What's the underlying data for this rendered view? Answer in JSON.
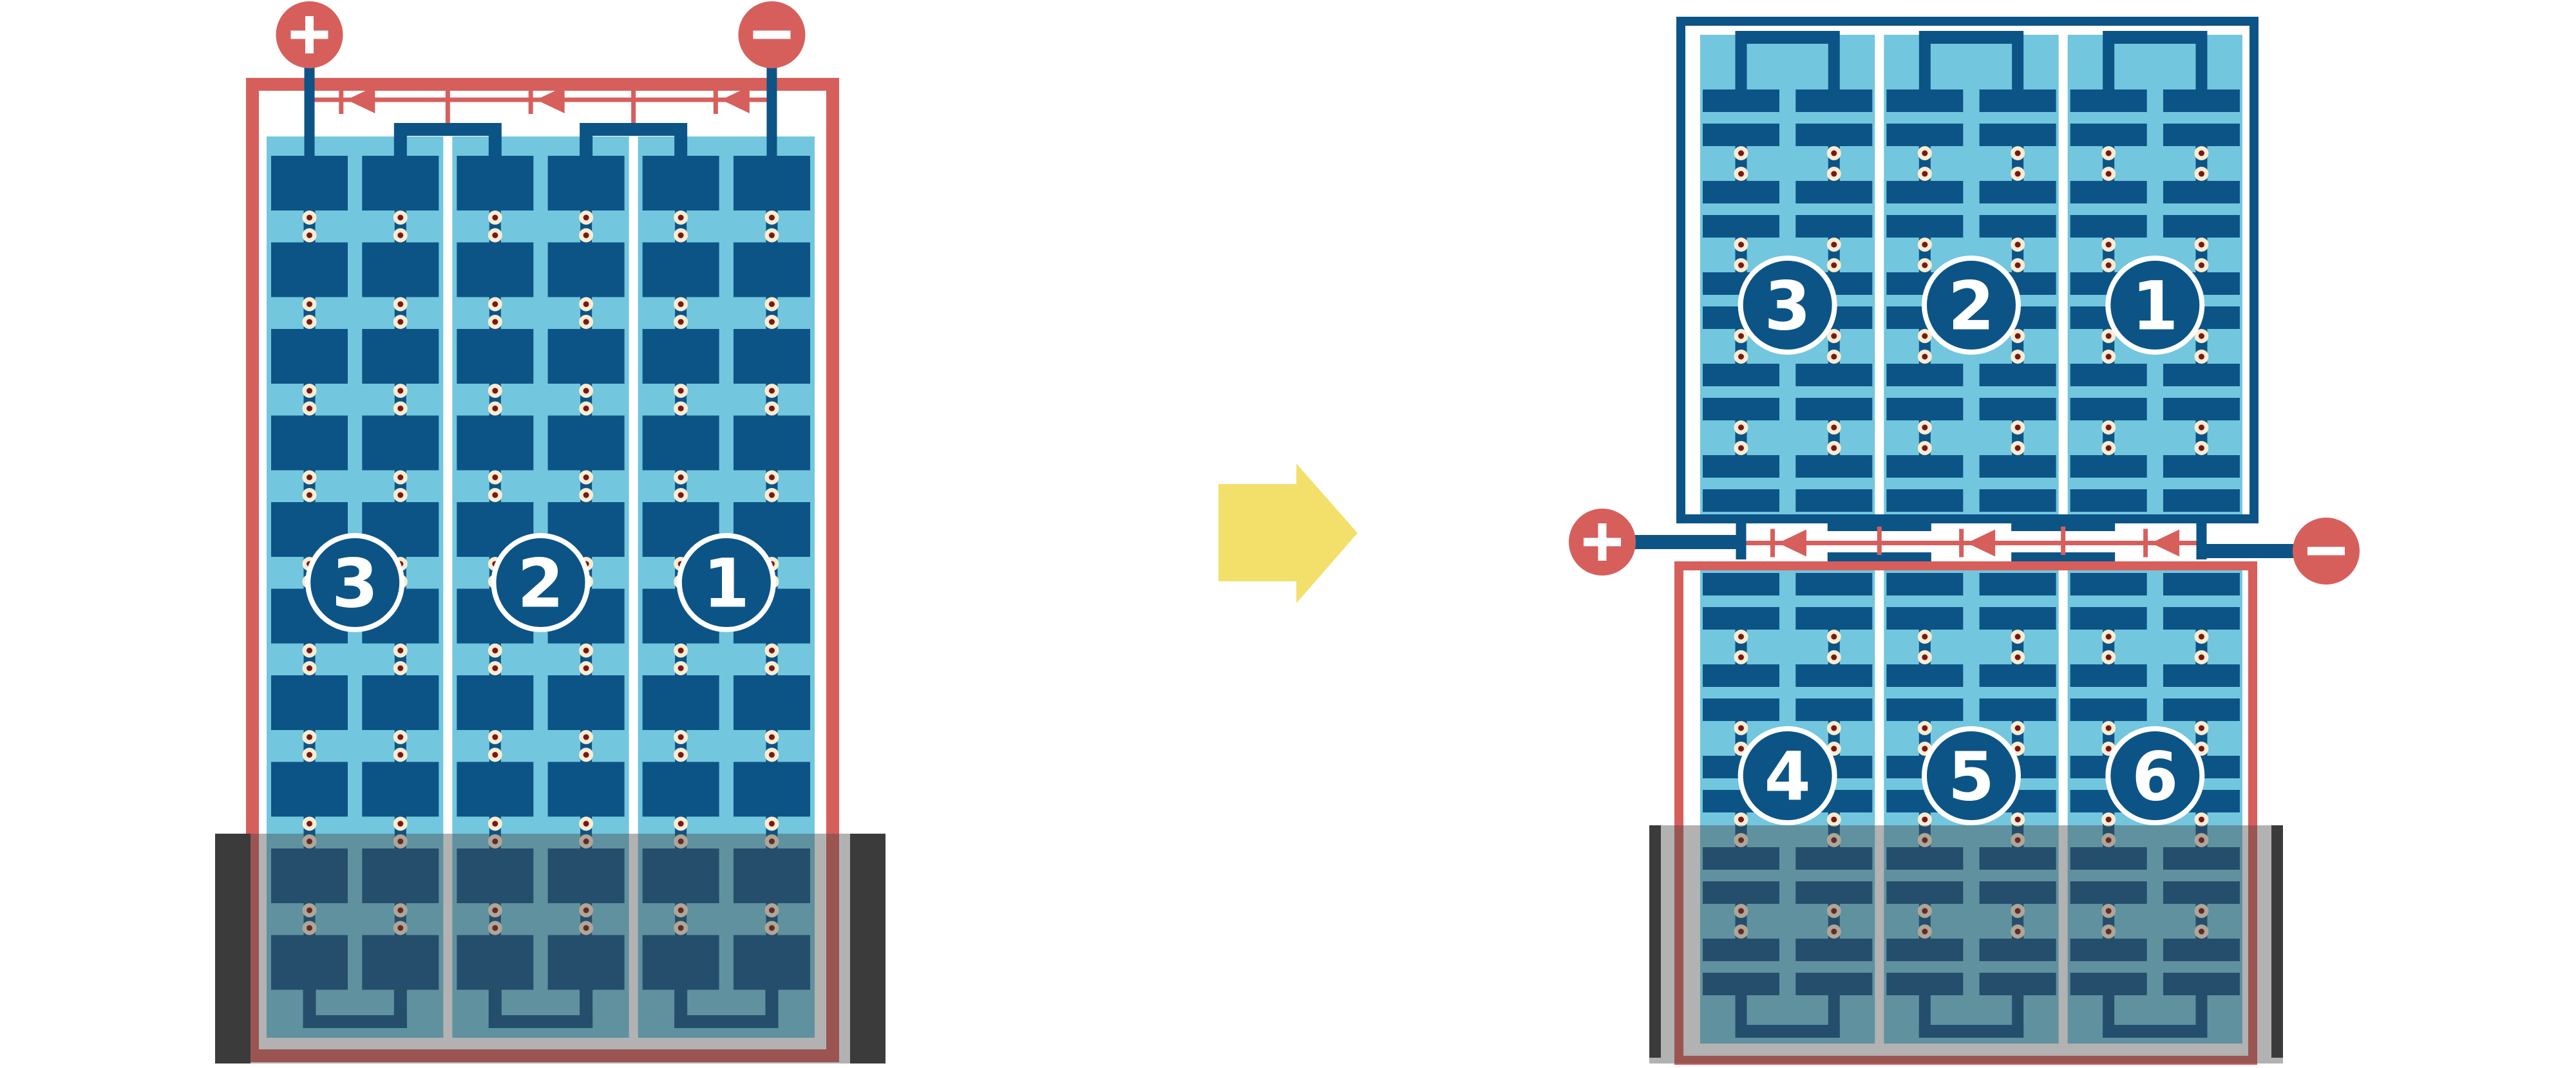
{
  "title": "solar-module-string-wiring-comparison",
  "colors": {
    "background": "#FFFFFF",
    "red": "#D65F5C",
    "dark_blue": "#0C5486",
    "light_blue": "#72C6DE",
    "cream": "#F8EDD2",
    "dot_red": "#7D1615",
    "yellow": "#F2E06A",
    "white": "#FFFFFF",
    "shade_fill": "rgba(72,72,72,0.42)",
    "shade_bar": "#3B3B3B"
  },
  "terminals": {
    "positive_label": "+",
    "negative_label": "−"
  },
  "left_panel": {
    "string_labels": [
      "3",
      "2",
      "1"
    ],
    "strings": 3,
    "columns_per_string": 2,
    "cell_rows": 10,
    "bypass_diodes": 3,
    "border_color_key": "red",
    "shade_position": "bottom"
  },
  "right_panel_top": {
    "string_labels": [
      "3",
      "2",
      "1"
    ],
    "strings": 3,
    "columns_per_string": 2,
    "cell_row_pairs": 5,
    "border_color_key": "dark_blue"
  },
  "right_panel_bottom": {
    "string_labels": [
      "4",
      "5",
      "6"
    ],
    "strings": 3,
    "columns_per_string": 2,
    "cell_row_pairs": 5,
    "border_color_key": "red",
    "shade_position": "bottom"
  },
  "strip": {
    "bypass_diodes": 3
  },
  "arrow": {
    "direction": "right"
  }
}
